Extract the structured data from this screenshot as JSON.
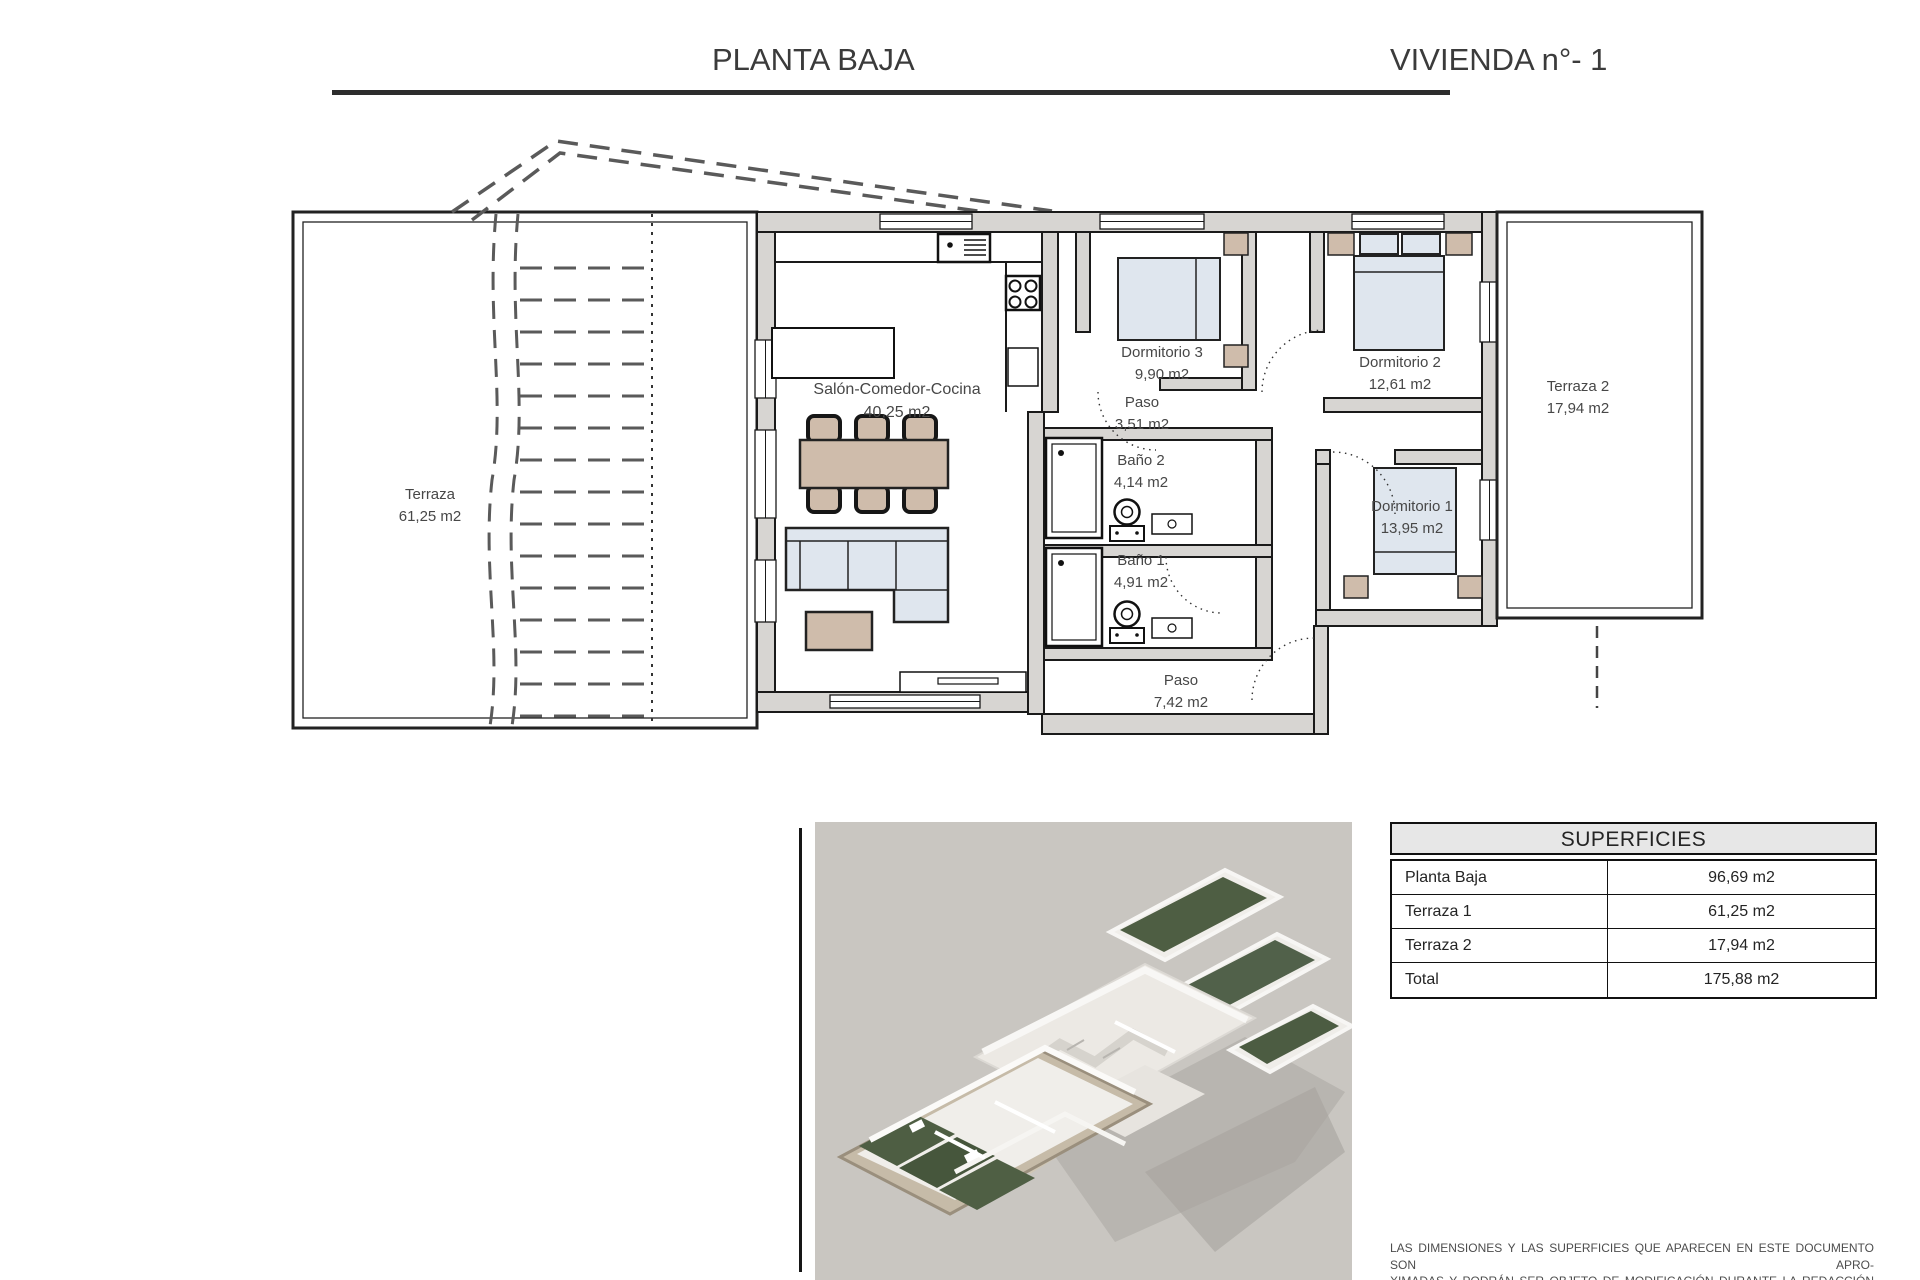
{
  "header": {
    "left_title": "PLANTA BAJA",
    "right_title": "VIVIENDA n°- 1"
  },
  "floor_plan": {
    "rooms": [
      {
        "name": "Terraza",
        "area": "61,25 m2"
      },
      {
        "name": "Salón-Comedor-Cocina",
        "area": "40,25 m2"
      },
      {
        "name": "Dormitorio 3",
        "area": "9,90 m2"
      },
      {
        "name": "Paso",
        "area": "3,51 m2"
      },
      {
        "name": "Dormitorio 2",
        "area": "12,61 m2"
      },
      {
        "name": "Terraza 2",
        "area": "17,94 m2"
      },
      {
        "name": "Baño 2",
        "area": "4,14 m2"
      },
      {
        "name": "Baño 1",
        "area": "4,91 m2"
      },
      {
        "name": "Dormitorio 1",
        "area": "13,95 m2"
      },
      {
        "name": "Paso",
        "area": "7,42 m2"
      }
    ]
  },
  "superficies_table": {
    "title": "SUPERFICIES",
    "rows": [
      {
        "label": "Planta Baja",
        "value": "96,69 m2"
      },
      {
        "label": "Terraza 1",
        "value": "61,25 m2"
      },
      {
        "label": "Terraza 2",
        "value": "17,94 m2"
      },
      {
        "label": "Total",
        "value": "175,88 m2"
      }
    ]
  },
  "disclaimer": {
    "line1": "LAS DIMENSIONES Y LAS SUPERFICIES QUE APARECEN EN ESTE DOCUMENTO SON APRO-",
    "line2": "XIMADAS Y PODRÁN SER OBJETO DE MODIFICACIÓN DURANTE LA REDACCIÓN DE LOS",
    "line3": "PROYECTOS BÁSICO Y DE EJECUCIÓN"
  },
  "colors": {
    "wall_fill": "#d7d5d2",
    "line": "#1a1a1a",
    "furniture_beige": "#cfbcab",
    "furniture_blue": "#dfe6ee",
    "table_header_bg": "#e7e7e7",
    "render_bg": "#c9c6c1"
  }
}
